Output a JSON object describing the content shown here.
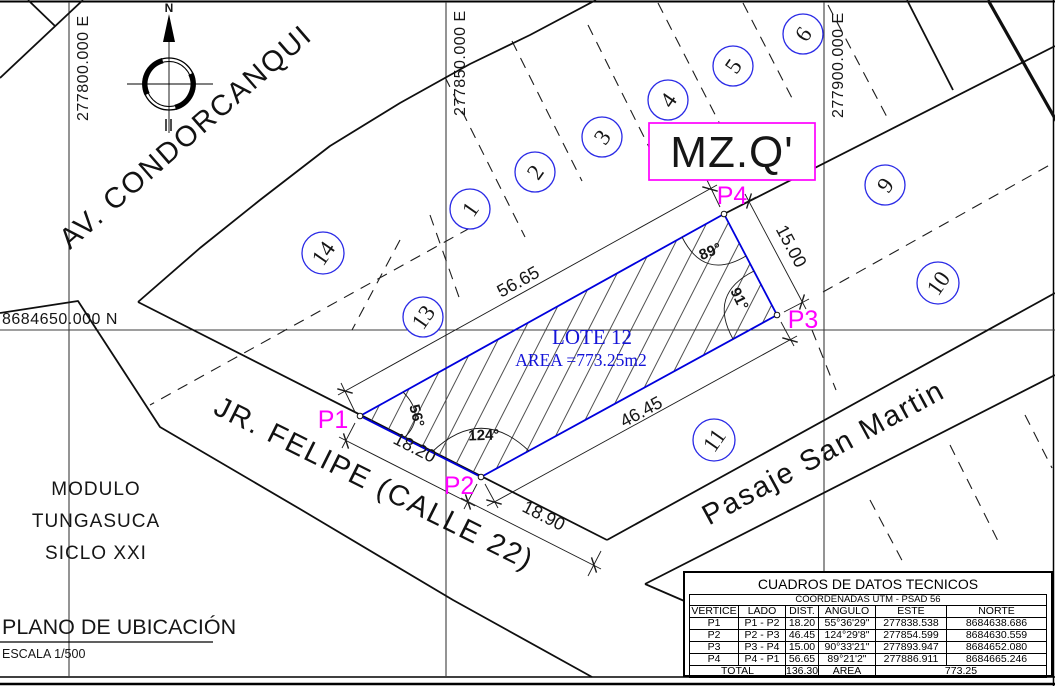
{
  "grid": {
    "east_labels": [
      "277800.000 E",
      "277850.000 E",
      "277900.000 E"
    ],
    "north_label": "8684650.000 N"
  },
  "compass": {
    "north_letter": "N"
  },
  "streets": {
    "avenue": "AV. CONDORCANQUI",
    "street": "JR. FELIPE (CALLE 22)",
    "passage": "Pasaje San Martin"
  },
  "block_label": "MZ.Q'",
  "neighborhood": {
    "line1": "MODULO",
    "line2": "TUNGASUCA",
    "line3": "SICLO XXI"
  },
  "title_block": {
    "title": "PLANO DE UBICACIÓN",
    "scale": "ESCALA 1/500"
  },
  "lot": {
    "name": "LOTE 12",
    "area_label": "AREA =773.25m2",
    "vertices": [
      "P1",
      "P2",
      "P3",
      "P4"
    ],
    "dims": {
      "p1p2": "18.20",
      "p2p3": "46.45",
      "p3p4": "15.00",
      "p4p1": "56.65",
      "street_ext": "18.90"
    },
    "angles": {
      "p1": "56°",
      "p2": "124°",
      "p3": "91°",
      "p4": "89°"
    }
  },
  "lot_numbers": [
    "1",
    "2",
    "3",
    "4",
    "5",
    "6",
    "9",
    "10",
    "11",
    "13",
    "14"
  ],
  "table": {
    "title": "CUADROS DE DATOS TECNICOS",
    "subtitle": "COORDENADAS UTM - PSAD 56",
    "headers": [
      "VERTICE",
      "LADO",
      "DIST.",
      "ANGULO",
      "ESTE",
      "NORTE"
    ],
    "rows": [
      [
        "P1",
        "P1 - P2",
        "18.20",
        "55°36'29\"",
        "277838.538",
        "8684638.686"
      ],
      [
        "P2",
        "P2 - P3",
        "46.45",
        "124°29'8\"",
        "277854.599",
        "8684630.559"
      ],
      [
        "P3",
        "P3 - P4",
        "15.00",
        "90°33'21\"",
        "277893.947",
        "8684652.080"
      ],
      [
        "P4",
        "P4 - P1",
        "56.65",
        "89°21'2\"",
        "277886.911",
        "8684665.246"
      ]
    ],
    "total": {
      "label": "TOTAL",
      "dist": "136.30",
      "area_label": "AREA",
      "area_value": "773.25"
    }
  },
  "colors": {
    "lot_line_blue": "#0000dd",
    "circle_blue": "#2a2ae6",
    "magenta": "#ff00ff",
    "line_black": "#111111"
  }
}
